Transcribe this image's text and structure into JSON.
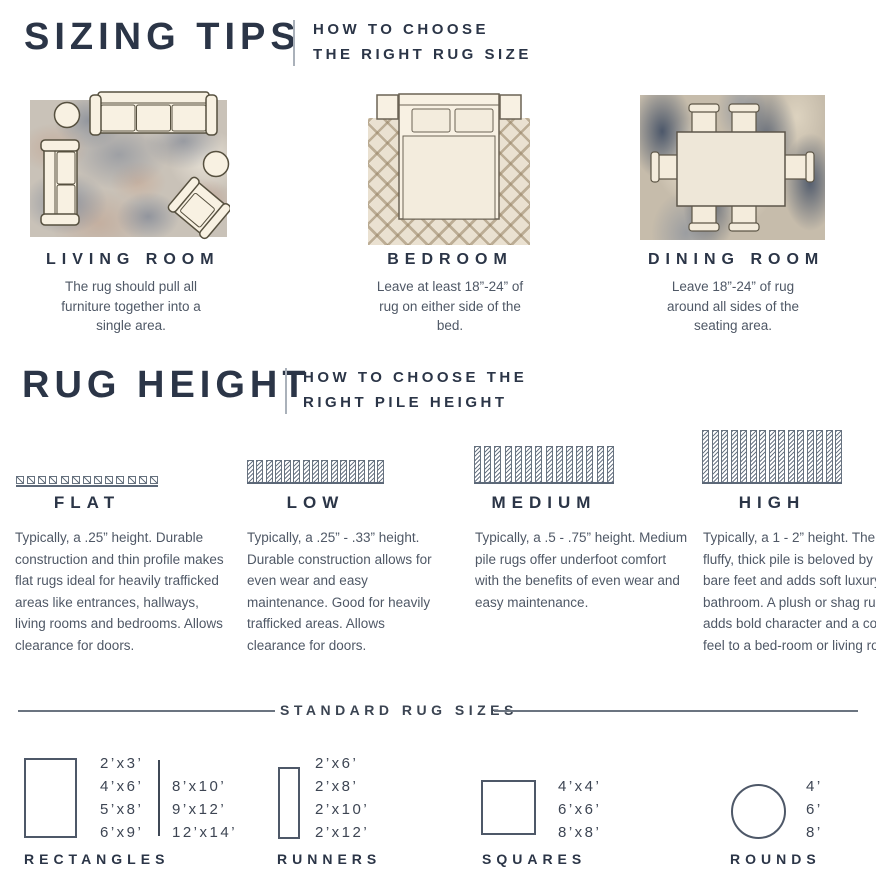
{
  "colors": {
    "navy": "#2b3547",
    "body_text": "#4f5866",
    "line_gray": "#6b7480",
    "rug_beige": "#eae1d1",
    "rug_blue": "#44536b",
    "rug_rust": "#b98a7a"
  },
  "header_sizing": {
    "title": "SIZING TIPS",
    "subtitle_line1": "HOW TO CHOOSE",
    "subtitle_line2": "THE RIGHT RUG SIZE"
  },
  "rooms": [
    {
      "label": "LIVING ROOM",
      "desc": "The rug should pull all furniture together into a single area."
    },
    {
      "label": "BEDROOM",
      "desc": "Leave at least 18”-24” of rug on either side of the bed."
    },
    {
      "label": "DINING ROOM",
      "desc": "Leave 18”-24” of rug around all sides of the seating area."
    }
  ],
  "header_height": {
    "title": "RUG HEIGHT",
    "subtitle_line1": "HOW TO CHOOSE THE",
    "subtitle_line2": "RIGHT PILE HEIGHT"
  },
  "piles": [
    {
      "label": "FLAT",
      "desc": "Typically, a .25” height. Durable construction and thin profile makes flat rugs ideal for heavily trafficked areas like entrances, hallways, living rooms and bedrooms. Allows clearance for doors."
    },
    {
      "label": "LOW",
      "desc": "Typically, a .25” - .33” height. Durable construction allows for even wear and easy maintenance. Good for heavily trafficked areas. Allows clearance for doors."
    },
    {
      "label": "MEDIUM",
      "desc": "Typically, a .5 - .75” height. Medium pile rugs offer underfoot comfort with the benefits of even wear and easy maintenance."
    },
    {
      "label": "HIGH",
      "desc": "Typically, a 1 - 2” height. The fluffy, thick pile is beloved by cold bare feet and adds soft luxury to a bathroom. A plush or shag rug adds bold character and a cozy feel to a bed-room or living room."
    }
  ],
  "sizes_section": {
    "title": "STANDARD RUG SIZES",
    "rectangles": {
      "label": "RECTANGLES",
      "col1": [
        "2’x3’",
        "4’x6’",
        "5’x8’",
        "6’x9’"
      ],
      "col2": [
        "8’x10’",
        "9’x12’",
        "12’x14’"
      ]
    },
    "runners": {
      "label": "RUNNERS",
      "list": [
        "2’x6’",
        "2’x8’",
        "2’x10’",
        "2’x12’"
      ]
    },
    "squares": {
      "label": "SQUARES",
      "list": [
        "4’x4’",
        "6’x6’",
        "8’x8’"
      ]
    },
    "rounds": {
      "label": "ROUNDS",
      "list": [
        "4’",
        "6’",
        "8’"
      ]
    }
  }
}
